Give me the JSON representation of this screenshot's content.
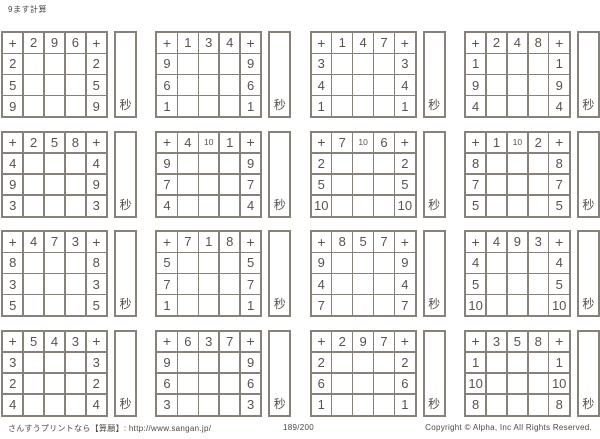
{
  "title": "9ます計算",
  "operator": "+",
  "seconds_label": "秒",
  "grids": [
    {
      "cols": [
        "2",
        "9",
        "6"
      ],
      "rows": [
        "2",
        "5",
        "9"
      ]
    },
    {
      "cols": [
        "1",
        "3",
        "4"
      ],
      "rows": [
        "9",
        "6",
        "1"
      ]
    },
    {
      "cols": [
        "1",
        "4",
        "7"
      ],
      "rows": [
        "3",
        "4",
        "1"
      ]
    },
    {
      "cols": [
        "2",
        "4",
        "8"
      ],
      "rows": [
        "1",
        "9",
        "4"
      ]
    },
    {
      "cols": [
        "2",
        "5",
        "8"
      ],
      "rows": [
        "4",
        "9",
        "3"
      ]
    },
    {
      "cols": [
        "4",
        "10",
        "1"
      ],
      "rows": [
        "9",
        "7",
        "4"
      ]
    },
    {
      "cols": [
        "7",
        "10",
        "6"
      ],
      "rows": [
        "2",
        "5",
        "10"
      ]
    },
    {
      "cols": [
        "1",
        "10",
        "2"
      ],
      "rows": [
        "8",
        "7",
        "5"
      ]
    },
    {
      "cols": [
        "4",
        "7",
        "3"
      ],
      "rows": [
        "8",
        "3",
        "5"
      ]
    },
    {
      "cols": [
        "7",
        "1",
        "8"
      ],
      "rows": [
        "5",
        "7",
        "1"
      ]
    },
    {
      "cols": [
        "8",
        "5",
        "7"
      ],
      "rows": [
        "9",
        "4",
        "7"
      ]
    },
    {
      "cols": [
        "4",
        "9",
        "3"
      ],
      "rows": [
        "4",
        "5",
        "10"
      ]
    },
    {
      "cols": [
        "5",
        "4",
        "3"
      ],
      "rows": [
        "3",
        "2",
        "4"
      ]
    },
    {
      "cols": [
        "6",
        "3",
        "7"
      ],
      "rows": [
        "9",
        "6",
        "3"
      ]
    },
    {
      "cols": [
        "2",
        "9",
        "7"
      ],
      "rows": [
        "2",
        "6",
        "1"
      ]
    },
    {
      "cols": [
        "3",
        "5",
        "8"
      ],
      "rows": [
        "1",
        "10",
        "8"
      ]
    }
  ],
  "footer": {
    "site": "さんすうプリントなら【算願】: http://www.sangan.jp/",
    "page": "189/200",
    "copyright": "Copyright © Alpha, Inc All Rights Reserved."
  },
  "colors": {
    "line": "#87817a",
    "digit": "#57534d",
    "text": "#4c4843"
  }
}
